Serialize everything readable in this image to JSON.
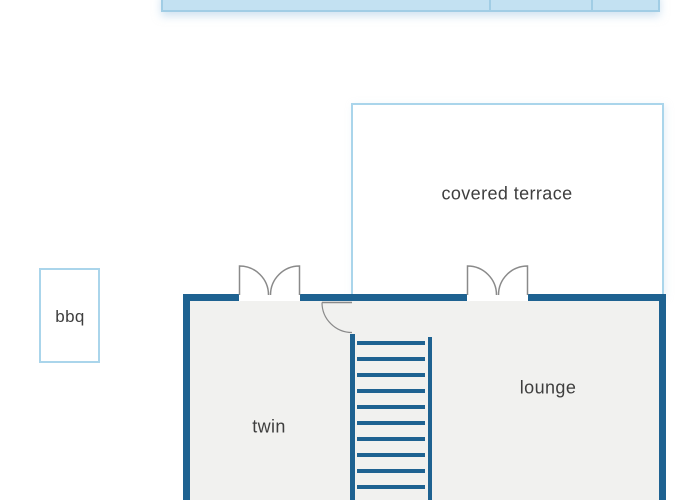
{
  "plan": {
    "title": "holiday-home floor plan (ground floor section)",
    "rooms": {
      "covered_terrace": {
        "label": "covered terrace"
      },
      "bbq": {
        "label": "bbq"
      },
      "twin": {
        "label": "twin"
      },
      "lounge": {
        "label": "lounge"
      }
    },
    "features": {
      "pool_strip_cells": 3,
      "stairs": {
        "tread_count": 10,
        "orientation": "vertical"
      },
      "doors": [
        {
          "type": "double-swing",
          "location": "twin-to-terrace-side"
        },
        {
          "type": "double-swing",
          "location": "lounge-to-covered-terrace"
        },
        {
          "type": "single-swing",
          "location": "twin-to-stair-landing"
        }
      ]
    },
    "colors": {
      "wall": "#1e6291",
      "terrace_border": "#aad5eb",
      "pool_fill": "#c3e1f2",
      "pool_border": "#a1cde5",
      "interior_fill": "#f1f1ef",
      "door_stroke": "#8a8a8a",
      "label_text": "#3e3e3e"
    }
  }
}
